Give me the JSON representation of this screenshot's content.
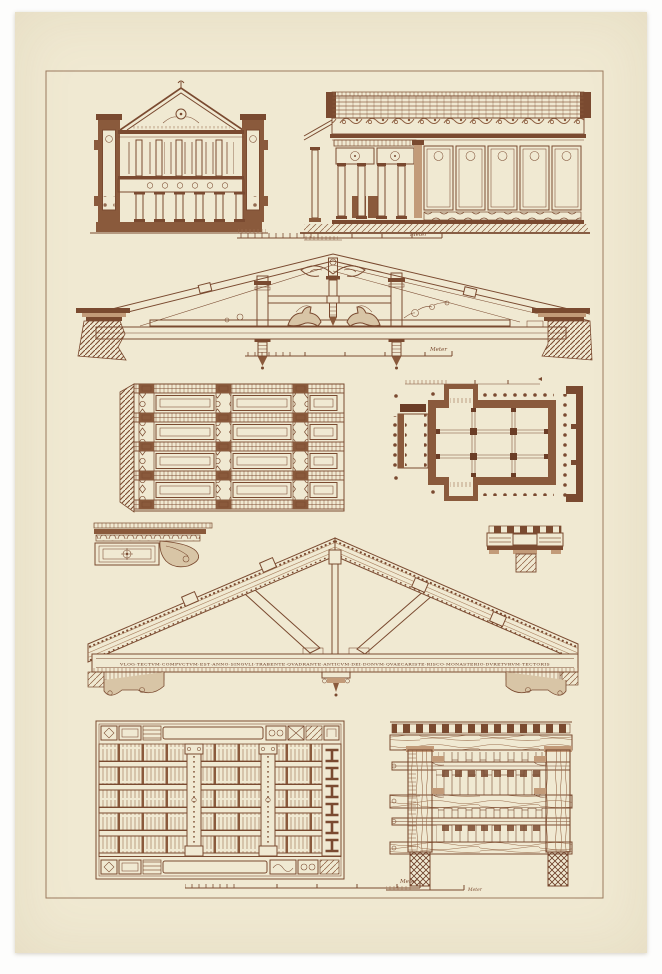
{
  "plate": {
    "background_color": "#fdfdfc",
    "paper_color": "#f0e9d2",
    "ink_color": "#7a4a30",
    "ink_dark": "#6b3d26",
    "ink_light": "#a9805f"
  },
  "labels": {
    "meter": "Meter"
  },
  "truss": {
    "inscription": "VLOG·TECTVM·COMPVCTVM·EST·ANNO·SINGVLI·TRABENTE·QVADRANTE·ANTICVM·DEI·DONVM·QVAECARISTE·RISCO·MONASTERIO·DVRETVRVM·TECTORIS"
  },
  "figures": {
    "top_left": "basilica-cross-section",
    "top_right": "basilica-longitudinal-section",
    "middle": "ornamented-king-post-truss",
    "mid_left": "coffered-ceiling-plan",
    "mid_right": "temple-floor-plan",
    "detail_left": "cornice-soffit-detail",
    "detail_right": "architrave-beam-junction-detail",
    "lower": "large-timber-truss-with-inscription",
    "bottom_left": "coffered-ceiling-elevation",
    "bottom_right": "timber-ceiling-cross-section"
  }
}
